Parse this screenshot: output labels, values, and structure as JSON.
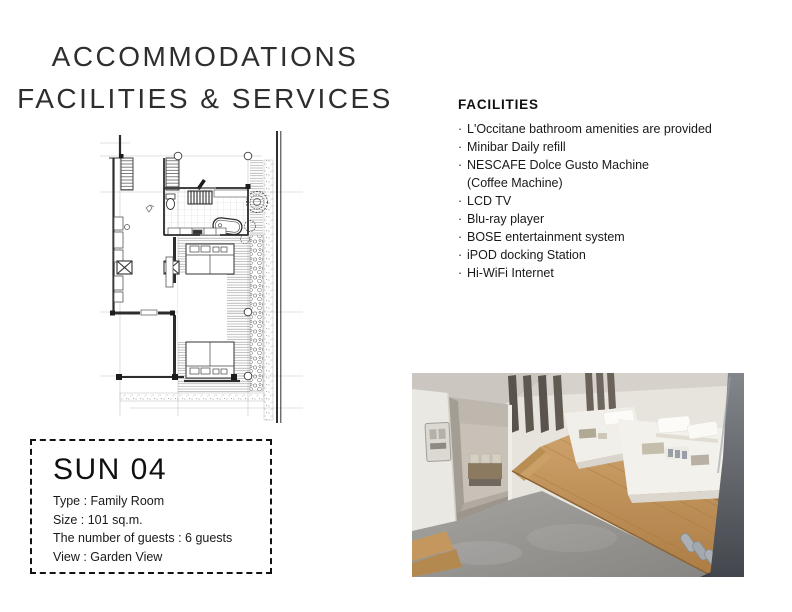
{
  "page": {
    "title_line1": "ACCOMMODATIONS",
    "title_line2": "FACILITIES & SERVICES"
  },
  "facilities": {
    "heading": "FACILITIES",
    "bullet": "·",
    "items": [
      "L'Occitane bathroom amenities are provided",
      "Minibar Daily refill",
      "NESCAFE Dolce Gusto Machine",
      "(Coffee Machine)",
      "LCD TV",
      "Blu-ray player",
      "BOSE entertainment system",
      "iPOD docking Station",
      "Hi-WiFi Internet"
    ]
  },
  "room": {
    "name": "SUN 04",
    "details": [
      "Type : Family Room",
      "Size : 101 sq.m.",
      "The number of guests : 6 guests",
      "View : Garden View"
    ]
  },
  "colors": {
    "text": "#1f1f1f",
    "plan_line": "#2f2f2f",
    "photo_wood": "#c0965e",
    "photo_floor": "#95938f"
  }
}
